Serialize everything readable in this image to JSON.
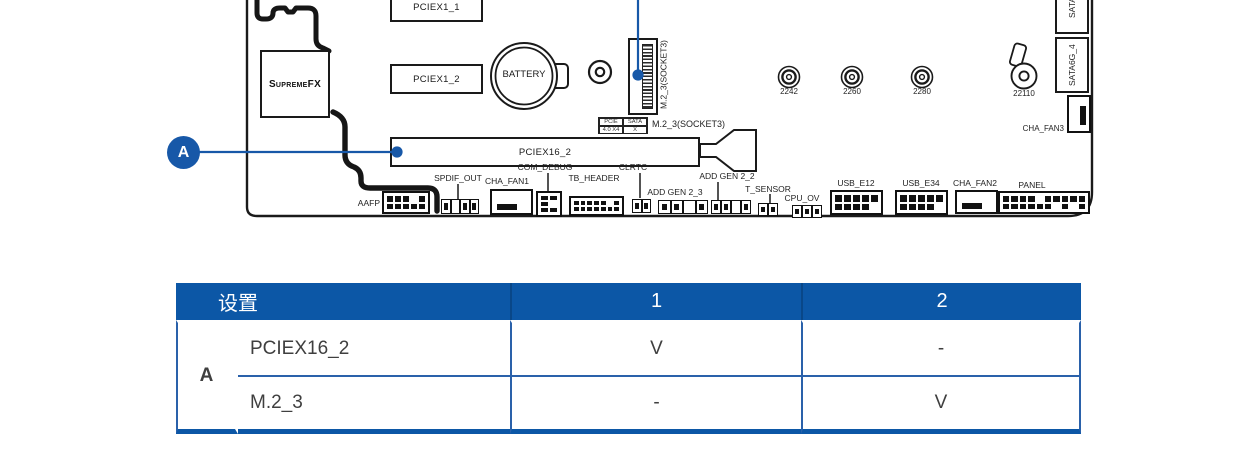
{
  "colors": {
    "accent_blue": "#1758a8",
    "table_header_blue": "#0c57a6",
    "group_cell_bg": "#a8b2d3",
    "line_black": "#1a1a1a"
  },
  "board": {
    "slots": {
      "pciex1_1": "PCIEX1_1",
      "pciex1_2": "PCIEX1_2",
      "pciex16_2": "PCIEX16_2"
    },
    "battery": "BATTERY",
    "audio_chip": "SupremeFX",
    "m2_socket_vertical_label": "M.2_3(SOCKET3)",
    "m2_socket_horizontal_label": "M.2_3(SOCKET3)",
    "m2_mode": {
      "pcie": "PCIE",
      "pcie_val": "4.0 X4",
      "sata": "SATA",
      "sata_val": "X"
    },
    "standoffs": [
      "2242",
      "2260",
      "2280",
      "22110"
    ],
    "sata_top": "SATA6G",
    "sata_bottom": "SATA6G_4",
    "headers": {
      "aafp": "AAFP",
      "spdif_out": "SPDIF_OUT",
      "cha_fan1": "CHA_FAN1",
      "com_debug": "COM_DEBUG",
      "tb_header": "TB_HEADER",
      "clrtc": "CLRTC",
      "add_gen_2_3": "ADD GEN 2_3",
      "add_gen_2_2": "ADD GEN 2_2",
      "t_sensor": "T_SENSOR",
      "cpu_ov": "CPU_OV",
      "usb_e12": "USB_E12",
      "usb_e34": "USB_E34",
      "cha_fan2": "CHA_FAN2",
      "cha_fan3": "CHA_FAN3",
      "panel": "PANEL"
    },
    "callout": "A"
  },
  "table": {
    "header_settings": "设置",
    "header_col1": "1",
    "header_col2": "2",
    "group_label": "A",
    "rows": [
      {
        "name": "PCIEX16_2",
        "col1": "V",
        "col2": "-"
      },
      {
        "name": "M.2_3",
        "col1": "-",
        "col2": "V"
      }
    ]
  }
}
